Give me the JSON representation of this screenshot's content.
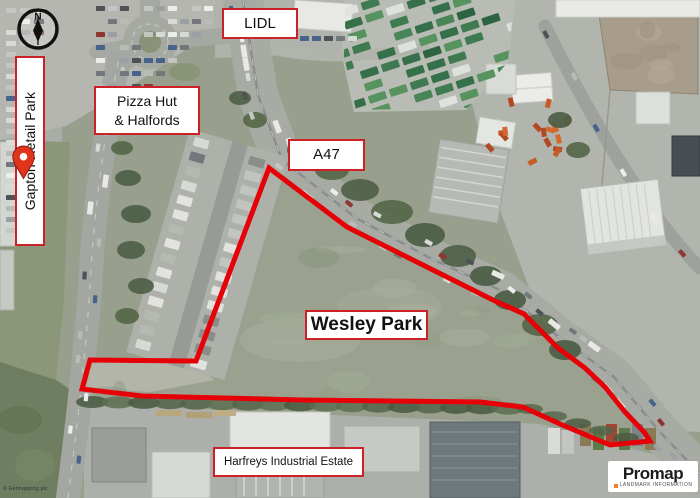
{
  "labels": {
    "gapton_retail_park": "Gapton Retail Park",
    "lidl": "LIDL",
    "pizza_hut_line1": "Pizza Hut",
    "pizza_hut_line2": "& Halfords",
    "a47": "A47",
    "wesley_park": "Wesley Park",
    "harfreys_industrial_estate": "Harfreys Industrial Estate"
  },
  "compass": {
    "north": "N"
  },
  "logo": {
    "brand": "Promap",
    "subtitle": "LANDMARK INFORMATION",
    "accent_color": "#f0812c"
  },
  "credit": "© Getmapping plc",
  "site_boundary": {
    "name": "Wesley Park site boundary",
    "stroke_color": "#e60008",
    "stroke_width": 5,
    "points": [
      [
        269,
        168
      ],
      [
        347,
        227
      ],
      [
        427,
        267
      ],
      [
        493,
        300
      ],
      [
        524,
        314
      ],
      [
        558,
        348
      ],
      [
        585,
        368
      ],
      [
        605,
        387
      ],
      [
        625,
        412
      ],
      [
        644,
        432
      ],
      [
        650,
        441
      ],
      [
        610,
        445
      ],
      [
        560,
        424
      ],
      [
        523,
        407
      ],
      [
        480,
        402
      ],
      [
        303,
        400
      ],
      [
        142,
        396
      ],
      [
        82,
        389
      ],
      [
        90,
        360
      ],
      [
        196,
        361
      ]
    ]
  },
  "label_style": {
    "border_color": "#cc2127",
    "background_color": "#ffffff",
    "text_color": "#111111"
  }
}
